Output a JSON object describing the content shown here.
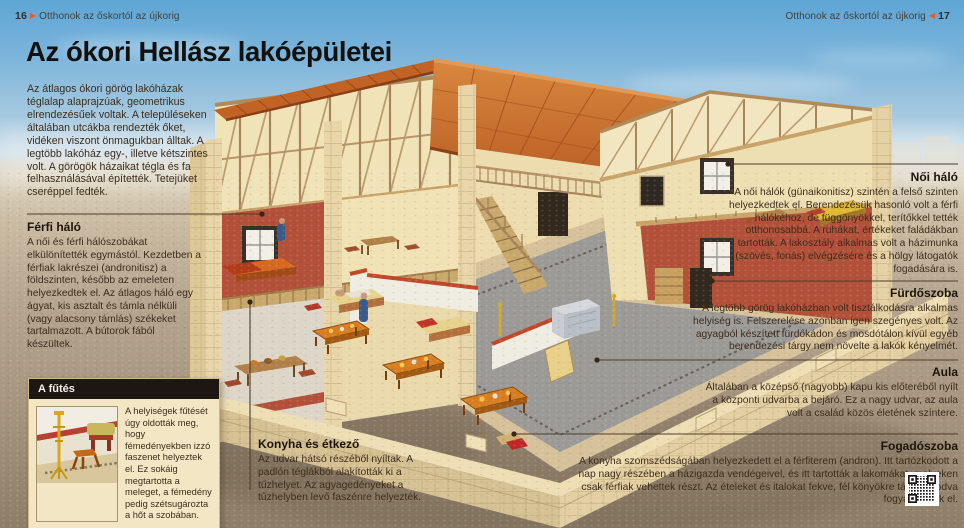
{
  "header": {
    "running_title": "Otthonok az őskortól az újkorig",
    "left_page_number": "16",
    "right_page_number": "17",
    "left_marker": "▶",
    "right_marker": "◀"
  },
  "page": {
    "title": "Az ókori Hellász lakóépületei",
    "intro": "Az átlagos ókori görög lakóházak téglalap alaprajzúak, geometrikus elrendezésűek voltak. A településeken általában utcákba rendezték őket, vidéken viszont önmagukban álltak. A legtöbb lakóház egy-, illetve kétszintes volt. A görögök házaikat tégla és fa felhasználásával építették. Tetejüket cseréppel fedték."
  },
  "callouts": {
    "ferfi_halo": {
      "title": "Férfi háló",
      "body": "A női és férfi hálószobákat elkülönítették egymástól. Kezdetben a férfiak lakrészei (andronitisz) a földszinten, később az emeleten helyezkedtek el. Az átlagos háló egy ágyat, kis asztalt és támla nélküli (vagy alacsony támlás) székeket tartalmazott. A bútorok fából készültek."
    },
    "noi_halo": {
      "title": "Női háló",
      "body": "A női hálók (günaikonitisz) szintén a felső szinten helyezkedtek el. Berendezésük hasonló volt a férfi hálókéhoz, de függönyökkel, terítőkkel tették otthonosabbá. A ruhákat, értékeket faládákban tartották. A lakosztály alkalmas volt a házimunka (szövés, fonás) elvégzésére és a hölgy látogatók fogadására is."
    },
    "furdoszoba": {
      "title": "Fürdőszoba",
      "body": "A legtöbb görög lakóházban volt tisztálkodásra alkalmas helyiség is. Felszerelése azonban igen szegényes volt. Az agyagból készített fürdőkádon és mosdótálon kívül egyéb berendezési tárgy nem növelte a lakók kényelmét."
    },
    "aula": {
      "title": "Aula",
      "body": "Általában a középső (nagyobb) kapu kis előteréből nyílt a központi udvarba a bejáró. Ez a nagy udvar, az aula volt a család közös életének színtere."
    },
    "fogadoszoba": {
      "title": "Fogadószoba",
      "body": "A konyha szomszédságában helyezkedett el a férfiterem (andron). Itt tartózkodott a nap nagy részében a házigazda vendégeivel, és itt tartották a lakomákat, melyeken csak férfiak vehettek részt. Az ételeket és italokat fekve, fél könyökre támaszkodva fogyasztották el."
    },
    "konyha": {
      "title": "Konyha és étkező",
      "body": "Az udvar hátsó részéből nyíltak. A padlón téglákból alakították ki a tűzhelyet. Az agyagedényeket a tűzhelyben levő faszénre helyezték."
    }
  },
  "sidebar_box": {
    "title": "A fűtés",
    "body": "A helyiségek fűtését úgy oldották meg, hogy fémedényekben izzó faszenet helyeztek el. Ez sokáig megtartotta a meleget, a fémedény pedig szétsugározta a hőt a szobában."
  },
  "illustration": {
    "description": "Kétszintes ókori görög lakóház átvágott (cutaway) 3D képe: cseréptető, fa fedélszék, emeleti hálók, lépcső, oszlopos erkély, központi udvar asztalokkal és heverőkkel, alacsony kőfal az előtérben."
  },
  "colors": {
    "accent_orange": "#e05f27",
    "roof_tile": "#c2651f",
    "wall_cream": "#eee0b4",
    "wall_red": "#b2503a",
    "box_header": "#1c1712",
    "body_text": "#3d2d1c",
    "lead_line": "#4e3c28"
  }
}
